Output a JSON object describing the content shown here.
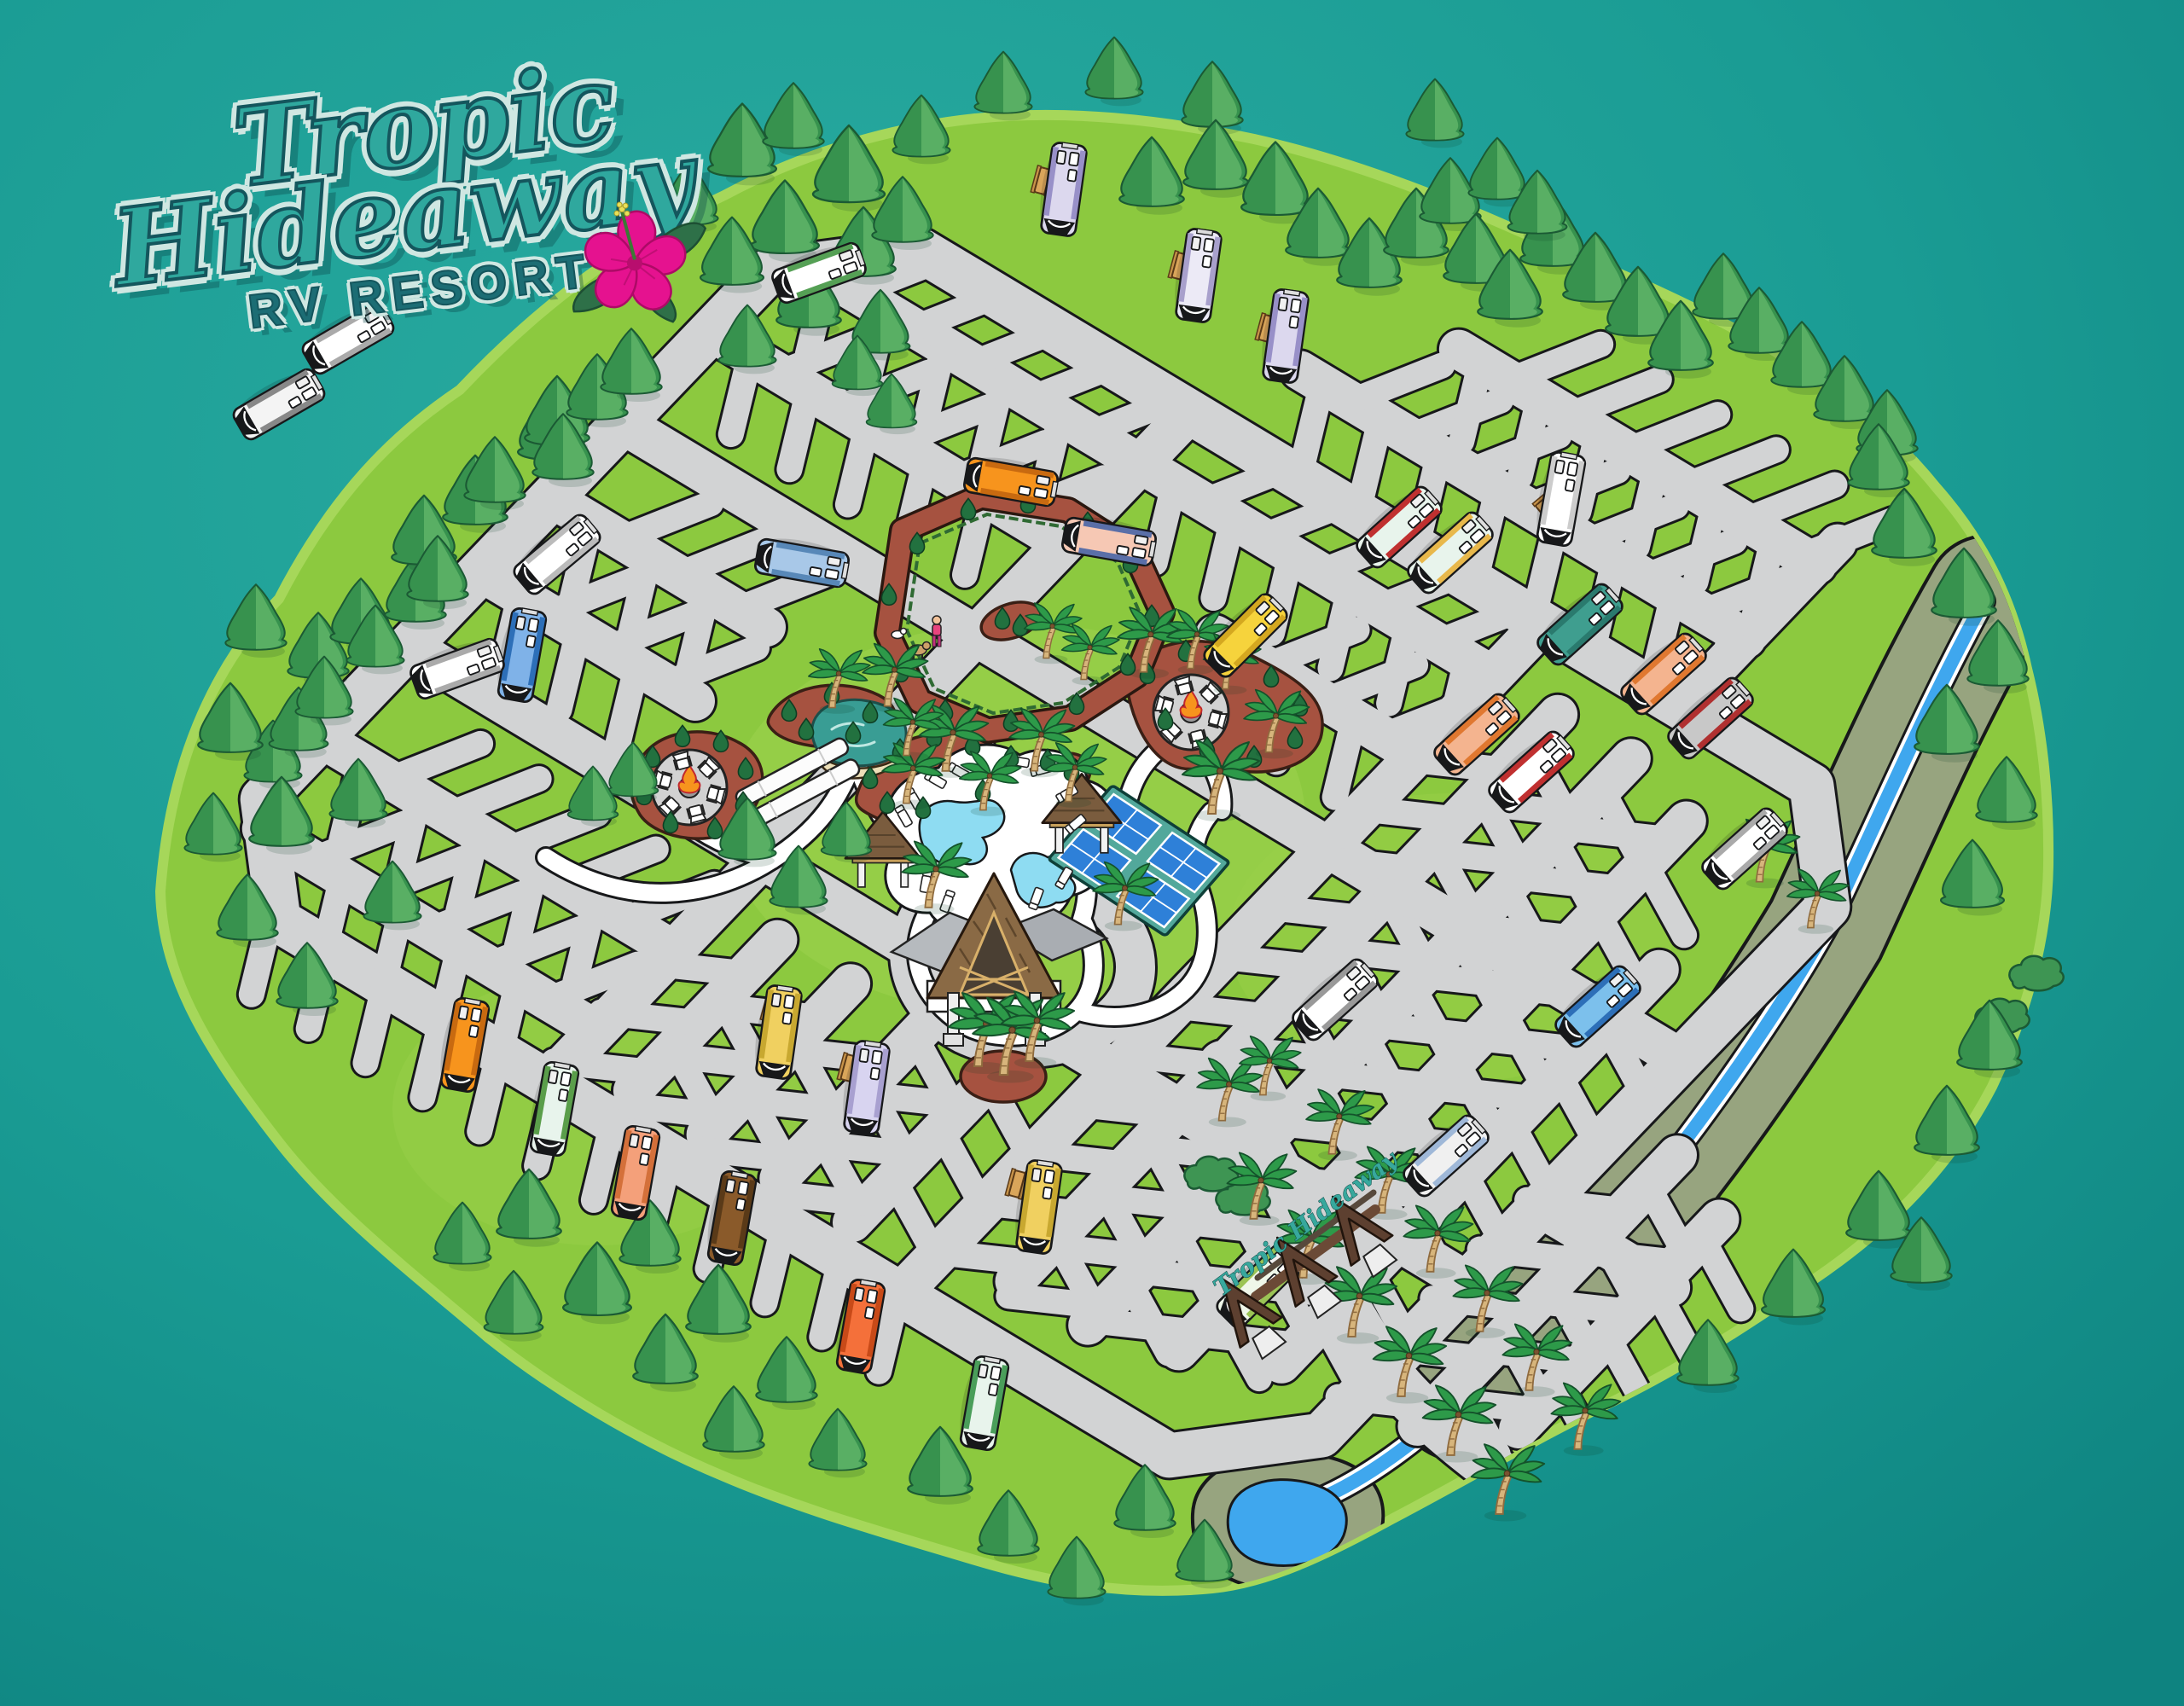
{
  "page": {
    "type": "illustrated-rv-resort-map"
  },
  "logo": {
    "word1": "Tropic",
    "word2": "Hideaway",
    "tagline": "RV RESORT"
  },
  "entrance_sign": {
    "text": "Tropic Hideaway"
  },
  "palette": {
    "background_teal": "#1A9C94",
    "background_teal_light": "#2BACA1",
    "background_teal_dark": "#0E8380",
    "island_green": "#8CC93F",
    "island_rim": "#A6D75A",
    "road_gray": "#D2D3D4",
    "outline_ink": "#17181A",
    "path_white": "#FFFFFF",
    "mulch_brown": "#A65240",
    "bush_green": "#22713F",
    "pine_green": "#3E9553",
    "palm_green": "#2D9A49",
    "trunk_tan": "#D7B57C",
    "pool_blue": "#8EDCF2",
    "pond_teal": "#399D94",
    "sand": "#ECDFB8",
    "court_blue": "#2E80D8",
    "court_base_teal": "#52A89B",
    "river_bank_olive": "#97A47F",
    "river_blue": "#3FA7EE",
    "thatch_brown": "#8A6A45",
    "fire_orange": "#F7941D",
    "logo_teal": "#2FA89E",
    "logo_outline": "#14565D",
    "logo_halo": "#CFE7E2",
    "tagline_teal": "#1C6D74",
    "hibiscus_pink": "#E5128F"
  },
  "map": {
    "features": [
      "entrance-arch",
      "river",
      "pond",
      "swimming-pools",
      "pickleball-courts",
      "clubhouse",
      "pool-pavilions",
      "dog-park",
      "fire-pit-lounges",
      "shuffleboard-courts",
      "rv-parking-sites",
      "picnic-tables",
      "pine-trees",
      "palm-trees"
    ],
    "rvs": [
      [
        1247,
        222,
        98,
        "#DCD8EE",
        "#9890C8"
      ],
      [
        1405,
        323,
        98,
        "#ECEAF6",
        "#A8A0CC"
      ],
      [
        1507,
        394,
        98,
        "#DCD8EE",
        "#9890C8"
      ],
      [
        960,
        320,
        160,
        "#FFFFFF",
        "#55A055"
      ],
      [
        408,
        397,
        150,
        "#FFFFFF",
        "#AAAAAA"
      ],
      [
        327,
        474,
        150,
        "#F4F4F4",
        "#888888"
      ],
      [
        612,
        768,
        100,
        "#7FB2E8",
        "#2D6FB8"
      ],
      [
        536,
        784,
        160,
        "#FFFFFF",
        "#AAAAAA"
      ],
      [
        653,
        650,
        140,
        "#FFFFFF",
        "#BBBBBB"
      ],
      [
        1185,
        565,
        190,
        "#F7941D",
        "#C86A10"
      ],
      [
        1300,
        635,
        190,
        "#F6C8B4",
        "#5A6FA8"
      ],
      [
        940,
        660,
        190,
        "#A8C8E8",
        "#5888B8"
      ],
      [
        1460,
        745,
        135,
        "#F6D33C",
        "#D4A820"
      ],
      [
        1640,
        618,
        138,
        "#E8F4EC",
        "#C03030"
      ],
      [
        1700,
        648,
        138,
        "#E8F4EC",
        "#E8B84B"
      ],
      [
        1830,
        585,
        100,
        "#FFFFFF",
        "#CCCCCC"
      ],
      [
        1852,
        732,
        138,
        "#3F9E8F",
        "#2A7A6E"
      ],
      [
        1950,
        790,
        138,
        "#F4B48F",
        "#E07830"
      ],
      [
        2005,
        842,
        138,
        "#C8C8C8",
        "#B03030"
      ],
      [
        2045,
        995,
        138,
        "#FFFFFF",
        "#AAAAAA"
      ],
      [
        1565,
        1172,
        138,
        "#FFFFFF",
        "#999999"
      ],
      [
        1873,
        1180,
        138,
        "#7CC0EC",
        "#2D6FB8"
      ],
      [
        1695,
        1355,
        138,
        "#F0F0F0",
        "#9FB8D8"
      ],
      [
        1475,
        1508,
        135,
        "#EFF7E9",
        "#9BC455"
      ],
      [
        545,
        1225,
        100,
        "#F7941D",
        "#C86A10"
      ],
      [
        650,
        1300,
        100,
        "#E8F4EC",
        "#5A9E4A"
      ],
      [
        745,
        1375,
        100,
        "#F4A07A",
        "#D4703A"
      ],
      [
        858,
        1428,
        100,
        "#8A5A2A",
        "#5A3A18"
      ],
      [
        1009,
        1555,
        100,
        "#F4703A",
        "#C84A18"
      ],
      [
        1154,
        1645,
        100,
        "#E8F4EC",
        "#4A9E5A"
      ],
      [
        913,
        1210,
        98,
        "#F0D060",
        "#C8A830"
      ],
      [
        1016,
        1275,
        98,
        "#D8D4F0",
        "#A8A0D0"
      ],
      [
        1218,
        1415,
        98,
        "#F0D060",
        "#C8A830"
      ],
      [
        1731,
        861,
        138,
        "#F4B48F",
        "#E07830"
      ],
      [
        1795,
        905,
        138,
        "#FFFFFF",
        "#C03030"
      ]
    ],
    "pines": [
      [
        870,
        205,
        0.95
      ],
      [
        930,
        172,
        0.85
      ],
      [
        995,
        235,
        1
      ],
      [
        920,
        295,
        0.95
      ],
      [
        858,
        332,
        0.88
      ],
      [
        1012,
        322,
        0.9
      ],
      [
        1080,
        182,
        0.8
      ],
      [
        1058,
        282,
        0.85
      ],
      [
        808,
        262,
        0.8
      ],
      [
        948,
        382,
        0.9
      ],
      [
        1032,
        412,
        0.82
      ],
      [
        876,
        428,
        0.8
      ],
      [
        1005,
        455,
        0.7
      ],
      [
        1045,
        500,
        0.7
      ],
      [
        320,
        915,
        0.8
      ],
      [
        350,
        878,
        0.82
      ],
      [
        373,
        793,
        0.85
      ],
      [
        423,
        753,
        0.85
      ],
      [
        440,
        780,
        0.8
      ],
      [
        487,
        727,
        0.85
      ],
      [
        497,
        660,
        0.9
      ],
      [
        513,
        703,
        0.85
      ],
      [
        557,
        613,
        0.9
      ],
      [
        580,
        587,
        0.85
      ],
      [
        647,
        537,
        0.95
      ],
      [
        653,
        520,
        0.9
      ],
      [
        660,
        560,
        0.85
      ],
      [
        700,
        490,
        0.85
      ],
      [
        740,
        460,
        0.85
      ],
      [
        300,
        760,
        0.85
      ],
      [
        270,
        880,
        0.9
      ],
      [
        330,
        990,
        0.9
      ],
      [
        290,
        1100,
        0.85
      ],
      [
        380,
        840,
        0.8
      ],
      [
        420,
        960,
        0.8
      ],
      [
        360,
        1180,
        0.85
      ],
      [
        460,
        1080,
        0.8
      ],
      [
        250,
        1000,
        0.8
      ],
      [
        1176,
        131,
        0.8
      ],
      [
        1306,
        114,
        0.8
      ],
      [
        1421,
        147,
        0.85
      ],
      [
        1682,
        163,
        0.8
      ],
      [
        1350,
        240,
        0.9
      ],
      [
        1425,
        220,
        0.9
      ],
      [
        1495,
        250,
        0.95
      ],
      [
        1545,
        300,
        0.9
      ],
      [
        1605,
        335,
        0.9
      ],
      [
        1660,
        300,
        0.9
      ],
      [
        1700,
        260,
        0.85
      ],
      [
        1730,
        330,
        0.9
      ],
      [
        1770,
        372,
        0.9
      ],
      [
        1820,
        310,
        0.9
      ],
      [
        1870,
        352,
        0.9
      ],
      [
        1920,
        392,
        0.9
      ],
      [
        1970,
        432,
        0.9
      ],
      [
        2020,
        372,
        0.85
      ],
      [
        2062,
        412,
        0.85
      ],
      [
        2112,
        452,
        0.85
      ],
      [
        2162,
        492,
        0.85
      ],
      [
        2212,
        532,
        0.85
      ],
      [
        1755,
        232,
        0.8
      ],
      [
        1802,
        272,
        0.82
      ],
      [
        2232,
        652,
        0.9
      ],
      [
        2302,
        722,
        0.9
      ],
      [
        2342,
        802,
        0.85
      ],
      [
        2282,
        882,
        0.9
      ],
      [
        2352,
        962,
        0.85
      ],
      [
        2312,
        1062,
        0.88
      ],
      [
        2202,
        572,
        0.85
      ],
      [
        2332,
        1252,
        0.9
      ],
      [
        2282,
        1352,
        0.9
      ],
      [
        2202,
        1452,
        0.9
      ],
      [
        2102,
        1542,
        0.88
      ],
      [
        2002,
        1622,
        0.85
      ],
      [
        2252,
        1502,
        0.85
      ],
      [
        620,
        1450,
        0.9
      ],
      [
        700,
        1540,
        0.95
      ],
      [
        780,
        1620,
        0.9
      ],
      [
        860,
        1700,
        0.85
      ],
      [
        762,
        1482,
        0.85
      ],
      [
        842,
        1562,
        0.9
      ],
      [
        922,
        1642,
        0.85
      ],
      [
        982,
        1722,
        0.8
      ],
      [
        602,
        1562,
        0.82
      ],
      [
        542,
        1480,
        0.8
      ],
      [
        1102,
        1752,
        0.9
      ],
      [
        1182,
        1822,
        0.85
      ],
      [
        1262,
        1872,
        0.8
      ],
      [
        1342,
        1792,
        0.85
      ],
      [
        1412,
        1852,
        0.8
      ],
      [
        742,
        932,
        0.7
      ],
      [
        876,
        1006,
        0.8
      ],
      [
        936,
        1062,
        0.8
      ],
      [
        992,
        1002,
        0.7
      ],
      [
        695,
        960,
        0.7
      ]
    ],
    "palms": [
      [
        1108,
        902,
        0.9
      ],
      [
        1062,
        940,
        0.82
      ],
      [
        1152,
        948,
        0.8
      ],
      [
        1088,
        1062,
        0.9
      ],
      [
        1212,
        902,
        0.85
      ],
      [
        1252,
        938,
        0.8
      ],
      [
        1310,
        1082,
        0.85
      ],
      [
        1420,
        952,
        1
      ],
      [
        975,
        828,
        0.8
      ],
      [
        1040,
        826,
        0.85
      ],
      [
        1062,
        884,
        0.78
      ],
      [
        1146,
        1248,
        1
      ],
      [
        1176,
        1258,
        1.05
      ],
      [
        1206,
        1242,
        0.95
      ],
      [
        1340,
        786,
        0.88
      ],
      [
        1487,
        880,
        0.85
      ],
      [
        1226,
        770,
        0.75
      ],
      [
        1270,
        795,
        0.75
      ],
      [
        1395,
        782,
        0.8
      ],
      [
        1436,
        806,
        0.75
      ],
      [
        1469,
        1427,
        0.9
      ],
      [
        1527,
        1496,
        0.92
      ],
      [
        1584,
        1565,
        0.95
      ],
      [
        1642,
        1635,
        0.95
      ],
      [
        1700,
        1704,
        0.95
      ],
      [
        1757,
        1773,
        0.95
      ],
      [
        1561,
        1351,
        0.88
      ],
      [
        1619,
        1420,
        0.9
      ],
      [
        1676,
        1489,
        0.9
      ],
      [
        1734,
        1559,
        0.9
      ],
      [
        1792,
        1628,
        0.9
      ],
      [
        1849,
        1697,
        0.9
      ],
      [
        1432,
        1312,
        0.85
      ],
      [
        1480,
        1282,
        0.8
      ],
      [
        2062,
        1032,
        0.85
      ],
      [
        2122,
        1086,
        0.8
      ]
    ],
    "bushes": [
      [
        1020,
        915
      ],
      [
        1055,
        882
      ],
      [
        1095,
        866
      ],
      [
        1140,
        876
      ],
      [
        1185,
        890
      ],
      [
        1228,
        894
      ],
      [
        1256,
        906
      ],
      [
        1152,
        930
      ],
      [
        1082,
        950
      ],
      [
        1040,
        944
      ],
      [
        765,
        890
      ],
      [
        800,
        866
      ],
      [
        845,
        872
      ],
      [
        874,
        904
      ],
      [
        871,
        944
      ],
      [
        838,
        974
      ],
      [
        786,
        967
      ],
      [
        755,
        934
      ],
      [
        925,
        836
      ],
      [
        975,
        816
      ],
      [
        1020,
        838
      ],
      [
        1000,
        862
      ],
      [
        945,
        858
      ],
      [
        1345,
        792
      ],
      [
        1390,
        766
      ],
      [
        1440,
        776
      ],
      [
        1490,
        796
      ],
      [
        1524,
        830
      ],
      [
        1518,
        868
      ],
      [
        1470,
        890
      ],
      [
        1415,
        880
      ],
      [
        1366,
        846
      ],
      [
        1075,
        640
      ],
      [
        1135,
        600
      ],
      [
        1205,
        592
      ],
      [
        1275,
        616
      ],
      [
        1325,
        662
      ],
      [
        1350,
        725
      ],
      [
        1322,
        782
      ],
      [
        1262,
        828
      ],
      [
        1185,
        848
      ],
      [
        1108,
        836
      ],
      [
        1056,
        790
      ],
      [
        1042,
        700
      ],
      [
        1175,
        728
      ],
      [
        1196,
        736
      ]
    ],
    "shrubs": [
      [
        2385,
        1145
      ],
      [
        2345,
        1195
      ],
      [
        1455,
        1408
      ],
      [
        1418,
        1380
      ]
    ],
    "picnic_tables": [
      [
        1222,
        212,
        -75
      ],
      [
        1383,
        312,
        -75
      ],
      [
        1485,
        385,
        -75
      ],
      [
        1815,
        588,
        -40
      ],
      [
        905,
        1182,
        -75
      ],
      [
        995,
        1252,
        -75
      ],
      [
        1192,
        1388,
        -75
      ]
    ]
  }
}
